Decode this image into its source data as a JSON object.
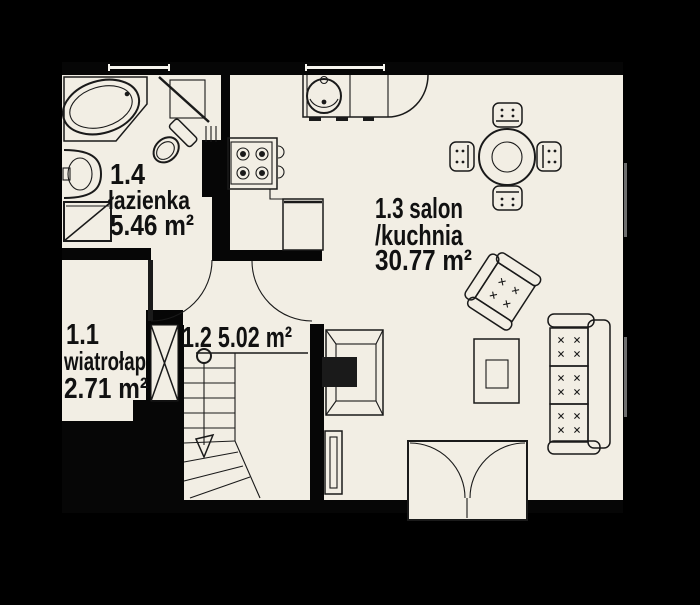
{
  "plan": {
    "title": "apartment-floor-plan",
    "colors": {
      "background": "#000000",
      "floor": "#f2eee4",
      "line": "#1a1a1a",
      "wall": "#060606"
    },
    "rooms": [
      {
        "number": "1.1",
        "name": "wiatrołap",
        "area": "2.71 m²",
        "lines": [
          "1.1",
          "wiatrołap",
          "2.71 m²"
        ]
      },
      {
        "number": "1.2",
        "name": "",
        "area": "5.02 m²",
        "lines": [
          "1.2 5.02 m²"
        ]
      },
      {
        "number": "1.3",
        "name": "salon/kuchnia",
        "area": "30.77 m²",
        "lines": [
          "1.3 salon",
          "/kuchnia",
          "30.77 m²"
        ]
      },
      {
        "number": "1.4",
        "name": "łazienka",
        "area": "5.46 m²",
        "lines": [
          "1.4",
          "łazienka",
          "5.46 m²"
        ]
      }
    ],
    "fixtures": [
      "bathtub",
      "washbasin",
      "toilet",
      "shower",
      "wall-cabinet",
      "vent-grille",
      "kitchen-sink",
      "stove",
      "kitchen-counter",
      "lower-counter",
      "dining-table",
      "dining-chairs",
      "armchair",
      "coffee-table",
      "sofa",
      "fireplace",
      "radiator",
      "staircase",
      "shaft",
      "entrance-double-door",
      "interior-door",
      "window"
    ]
  }
}
